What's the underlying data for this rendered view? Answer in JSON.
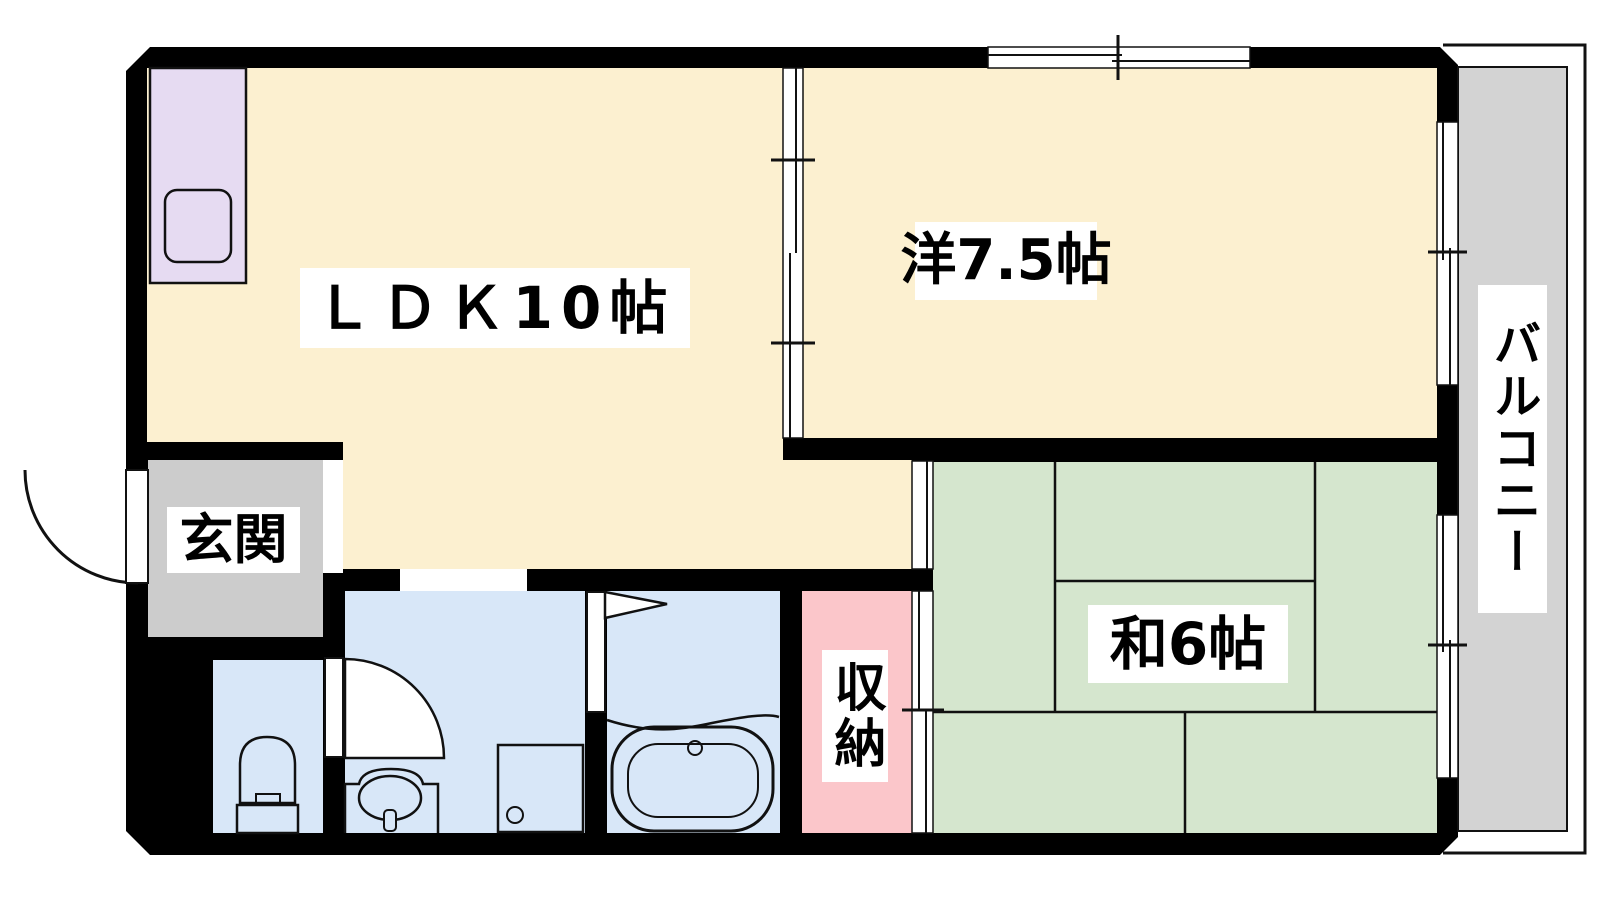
{
  "plan": {
    "type": "apartment-floor-plan",
    "rooms": {
      "ldk": {
        "label": "ＬＤＫ10帖"
      },
      "western_room": {
        "label": "洋7.5帖"
      },
      "japanese_room": {
        "label": "和6帖"
      },
      "entrance": {
        "label": "玄関"
      },
      "storage": {
        "label": "収納"
      },
      "balcony": {
        "label": "バルコニー"
      }
    },
    "colors": {
      "wall": "#000000",
      "line": "#111111",
      "ldk_floor": "#FCF0D0",
      "tatami_green": "#D5E6CE",
      "wet_area_blue": "#D8E7F8",
      "storage_pink": "#FBC6CA",
      "kitchen_purple": "#E6DBF2",
      "entrance_gray": "#CCCCCC",
      "balcony_gray": "#D3D3D3",
      "opening_white": "#FFFFFF",
      "label_bg": "#FFFFFF",
      "label_text": "#000000"
    }
  }
}
